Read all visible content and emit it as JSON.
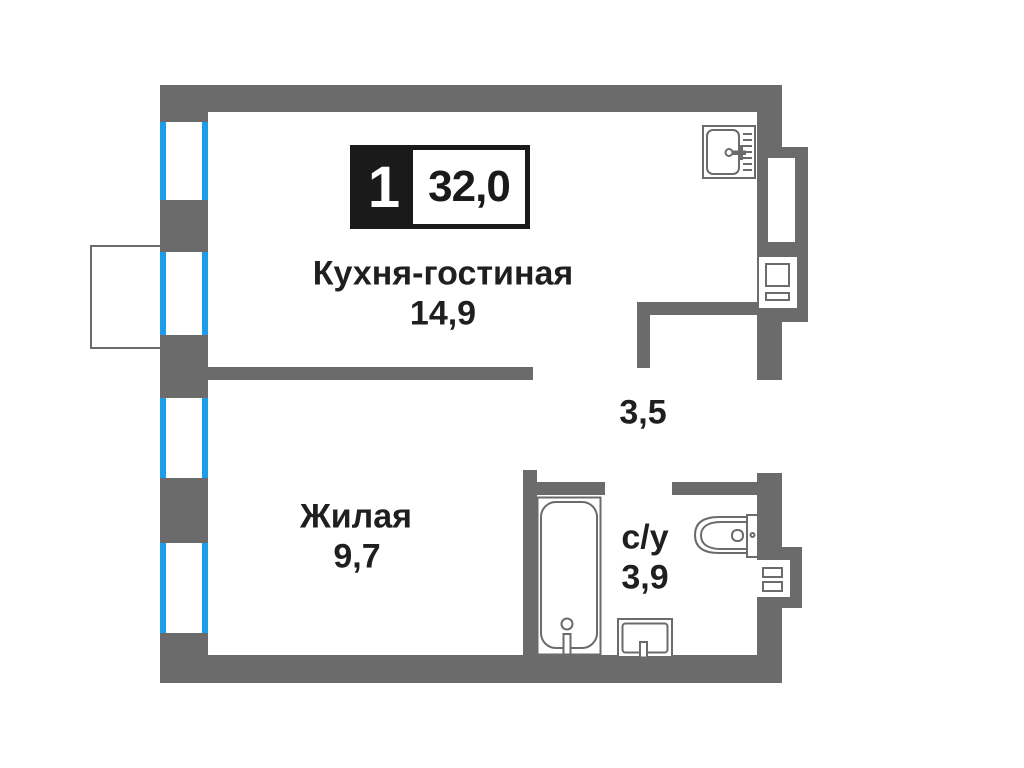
{
  "floorplan": {
    "badge": {
      "room_count": "1",
      "total_area": "32,0"
    },
    "rooms": {
      "kitchen_living": {
        "name": "Кухня-гостиная",
        "area": "14,9"
      },
      "living": {
        "name": "Жилая",
        "area": "9,7"
      },
      "bathroom": {
        "name": "с/у",
        "area": "3,9"
      },
      "hallway": {
        "area": "3,5"
      }
    },
    "colors": {
      "wall": "#6b6b6b",
      "window": "#1e9ce9",
      "text": "#1f1f1f",
      "badge": "#1a1a1a",
      "fixture": "#6b6b6b"
    },
    "icons": [
      "kitchen-sink-icon",
      "bathtub-icon",
      "washbasin-icon",
      "toilet-icon",
      "vent-shaft-icon",
      "window-icon",
      "balcony-outline"
    ]
  }
}
